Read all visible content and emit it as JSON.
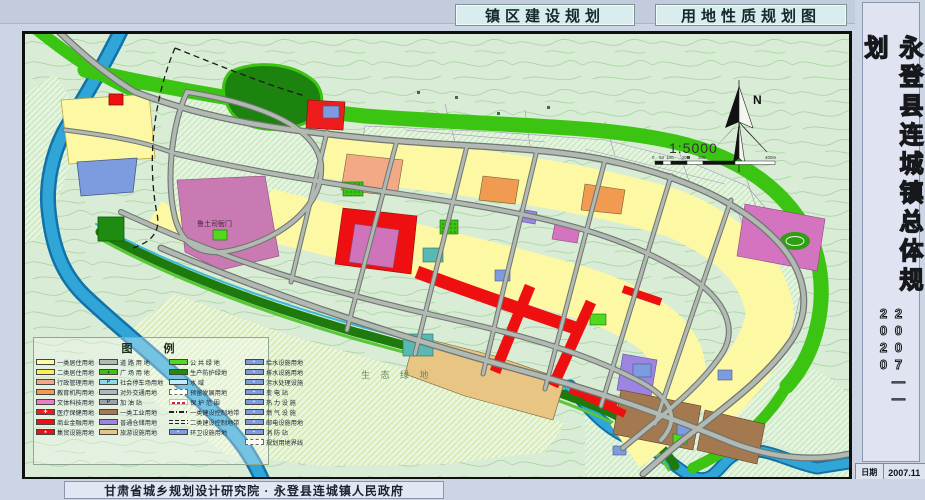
{
  "titles": {
    "left_tab": "镇区建设规划",
    "right_tab": "用地性质规划图"
  },
  "sidebar": {
    "title": "永登县连城镇总体规划",
    "years": "2007——2020",
    "date_label": "日期",
    "date_value": "2007.11",
    "sheet_label": "图号",
    "sheet_value": "08"
  },
  "footer": {
    "credit": "甘肃省城乡规划设计研究院 · 永登县连城镇人民政府"
  },
  "map": {
    "north_label": "N",
    "scale_text": "1:5000",
    "scale_ticks": [
      "0",
      "50",
      "100",
      "200",
      "300",
      "400m"
    ],
    "labels": {
      "heritage": "鲁土司衙门",
      "eco_green": "生 态 绿 地"
    }
  },
  "colors": {
    "river": "#2fa5d8",
    "road": "#b2b8b2",
    "public_green": "#3cc412",
    "residential1": "#fdf8a4",
    "commercial": "#ee1010",
    "outer_bg": "#ccd5e4"
  },
  "legend": {
    "title": "图  例",
    "c1": [
      {
        "color": "#fdfaa8",
        "label": "一类居住用地"
      },
      {
        "color": "#fdee58",
        "label": "二类居住用地"
      },
      {
        "color": "#f4a986",
        "label": "行政管理用地"
      },
      {
        "color": "#f09a52",
        "label": "教育机构用地"
      },
      {
        "color": "#e87fc4",
        "label": "文体科技用地"
      },
      {
        "color": "#ee1c1c",
        "label": "医疗保健用地"
      },
      {
        "color": "#ee1010",
        "label": "商业金融用地"
      },
      {
        "color": "#ee1010",
        "label": "集贸设施用地"
      }
    ],
    "c2": [
      {
        "color": "#b2b8b2",
        "label": "道 路 用 地"
      },
      {
        "color": "#3cc412",
        "label": "广 场 用 地"
      },
      {
        "color": "#8fd8e8",
        "label": "社会停车场用地"
      },
      {
        "color": "#aeb6be",
        "label": "对外交通用地"
      },
      {
        "color": "#99a2a8",
        "label": "加 油 站"
      },
      {
        "color": "#a5794f",
        "label": "一类工业用地"
      },
      {
        "color": "#9c84e0",
        "label": "普通仓储用地"
      },
      {
        "color": "#e9c584",
        "label": "旅游设施用地"
      }
    ],
    "c3": [
      {
        "color": "#52d81e",
        "label": "公 共 绿 地"
      },
      {
        "color": "#1e8c10",
        "label": "生产防护绿地"
      },
      {
        "color": "#bfeef8",
        "label": "水    域"
      },
      {
        "color": "",
        "label": "预留发展用地"
      },
      {
        "color": "",
        "label": "保 护 范 围"
      },
      {
        "color": "",
        "label": "一类建设控制地带"
      },
      {
        "color": "",
        "label": "二类建设控制地带"
      },
      {
        "color": "#7d9ce0",
        "label": "环卫设施用地"
      }
    ],
    "c4": [
      {
        "color": "#7d9ce0",
        "label": "给水设施用地"
      },
      {
        "color": "#7d9ce0",
        "label": "排水设施用地"
      },
      {
        "color": "#7d9ce0",
        "label": "污水处理设施"
      },
      {
        "color": "#7d9ce0",
        "label": "变 电 站"
      },
      {
        "color": "#7d9ce0",
        "label": "热 力 设 施"
      },
      {
        "color": "#7d9ce0",
        "label": "燃 气 设 施"
      },
      {
        "color": "#7d9ce0",
        "label": "邮电设施用地"
      },
      {
        "color": "#7d9ce0",
        "label": "消 防 站"
      },
      {
        "color": "",
        "label": "规划用地界线"
      }
    ]
  }
}
